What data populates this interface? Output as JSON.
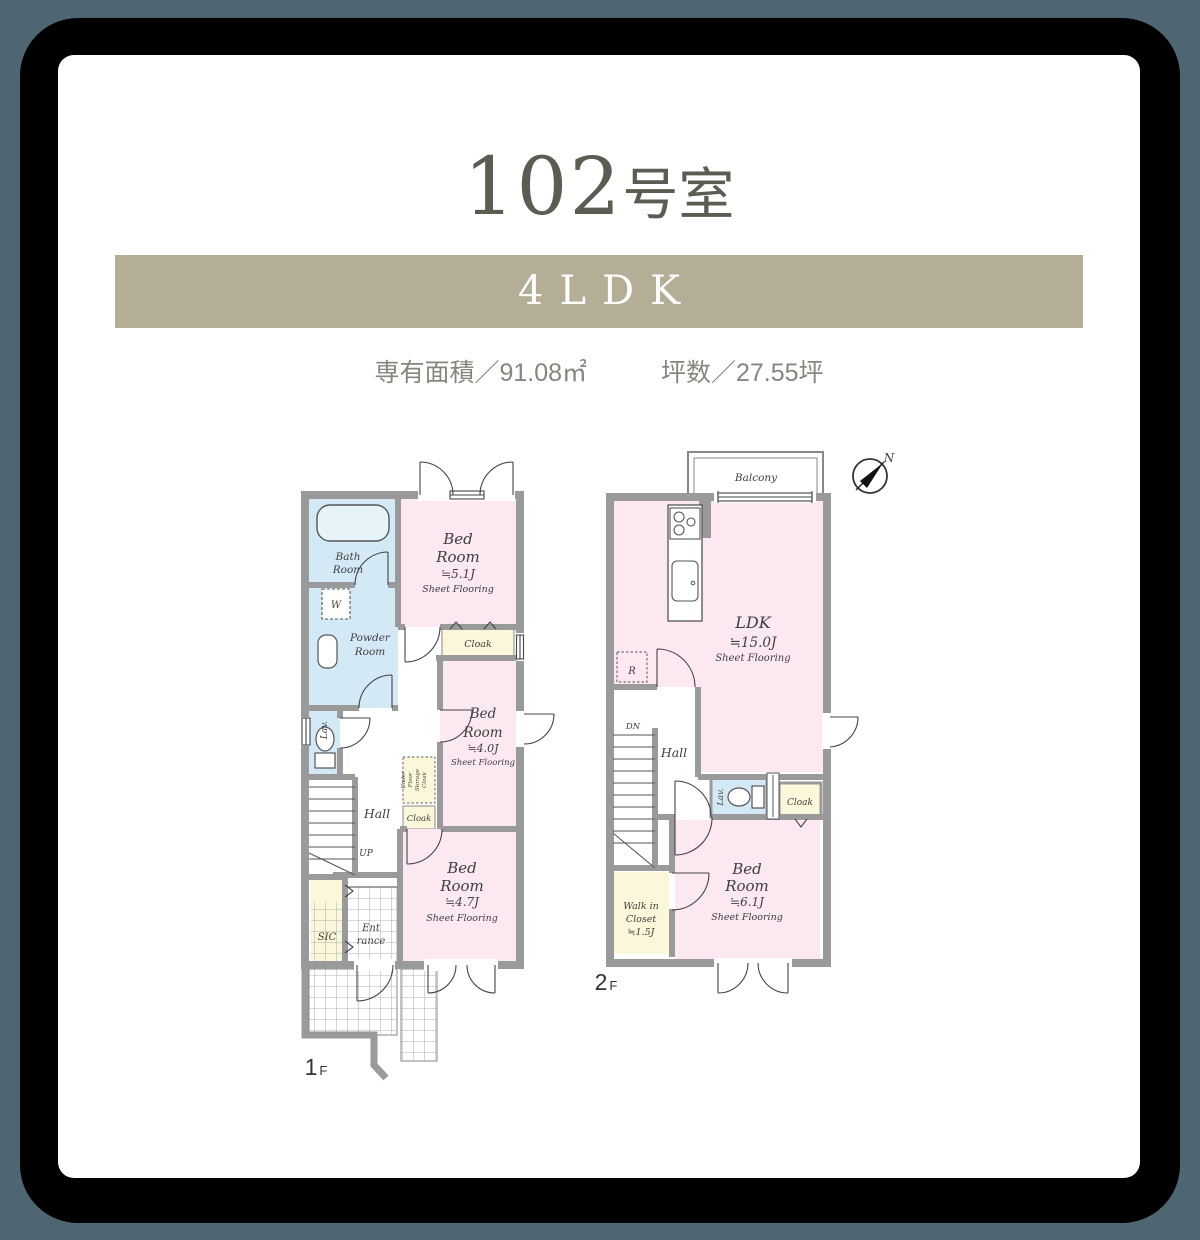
{
  "page": {
    "background_color": "#4e6671",
    "frame_color": "#000000",
    "card_color": "#ffffff"
  },
  "header": {
    "title_number": "102",
    "title_suffix": "号室",
    "plan_type": "4LDK",
    "plan_type_band_color": "#b5ae96",
    "area_label": "専有面積／91.08㎡",
    "tsubo_label": "坪数／27.55坪"
  },
  "palette": {
    "wall": "#9a9a9a",
    "room_pink": "#fbe8f0",
    "room_blue": "#d3eaf6",
    "room_yellow": "#fbf7da",
    "bathtub_fill": "#e6f4fa"
  },
  "floor1": {
    "floor_num": "1",
    "floor_suffix": "F",
    "bath": {
      "l1": "Bath",
      "l2": "Room"
    },
    "washer": "W",
    "powder": {
      "l1": "Powder",
      "l2": "Room"
    },
    "lav": "Lav.",
    "hall": "Hall",
    "up": "UP",
    "sic": "SIC",
    "entrance": {
      "l1": "Ent",
      "l2": "rance"
    },
    "bed1": {
      "l1": "Bed",
      "l2": "Room",
      "l3": "≒5.1J",
      "l4": "Sheet Flooring"
    },
    "cloak1": "Cloak",
    "bed2": {
      "l1": "Bed",
      "l2": "Room",
      "l3": "≒4.0J",
      "l4": "Sheet Flooring"
    },
    "storage": {
      "l1": "Under",
      "l2": "Floor",
      "l3": "Storage",
      "l4": "Cloak"
    },
    "cloak2": "Cloak",
    "bed3": {
      "l1": "Bed",
      "l2": "Room",
      "l3": "≒4.7J",
      "l4": "Sheet Flooring"
    }
  },
  "floor2": {
    "floor_num": "2",
    "floor_suffix": "F",
    "balcony": "Balcony",
    "ldk": {
      "l1": "LDK",
      "l2": "≒15.0J",
      "l3": "Sheet Flooring"
    },
    "fridge": "R",
    "dn": "DN",
    "hall": "Hall",
    "lav": "Lav.",
    "cloak": "Cloak",
    "bed": {
      "l1": "Bed",
      "l2": "Room",
      "l3": "≒6.1J",
      "l4": "Sheet Flooring"
    },
    "wic": {
      "l1": "Walk in",
      "l2": "Closet",
      "l3": "≒1.5J"
    },
    "compass_north": "N"
  }
}
